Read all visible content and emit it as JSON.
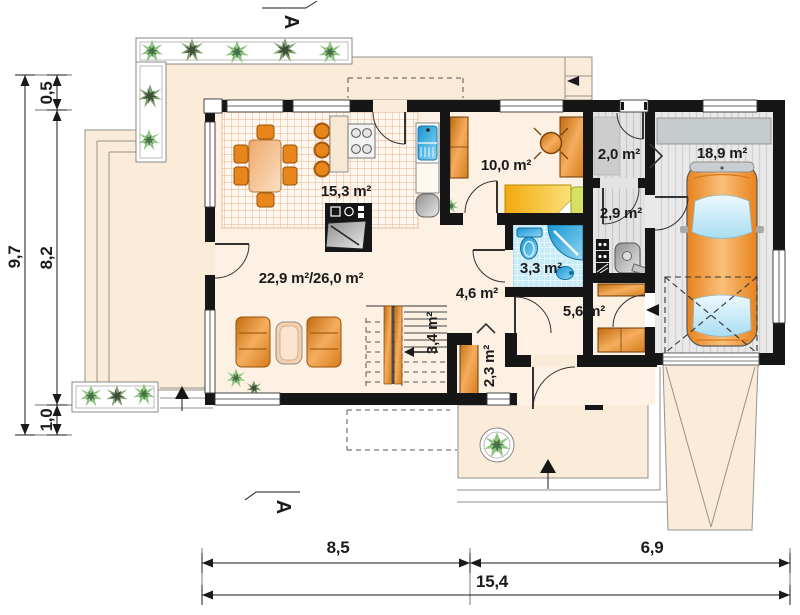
{
  "plan_type": "house ground floor plan",
  "section_markers": {
    "top": "A",
    "bottom": "A"
  },
  "rooms": {
    "kitchen_dining": "15,3 m²",
    "living_room": "22,9 m²/26,0 m²",
    "bedroom": "10,0 m²",
    "entry": "2,0 m²",
    "garage": "18,9 m²",
    "boiler_room": "2,9 m²",
    "bathroom": "3,3 m²",
    "hall": "4,6 m²",
    "corridor": "5,6 m²",
    "stairs": "3,4 m²",
    "vestibule": "2,3 m²"
  },
  "dimensions": {
    "left_total": "9,7",
    "left_top": "0,5",
    "left_middle": "8,2",
    "left_bottom": "1,0",
    "bottom_left": "8,5",
    "bottom_right": "6,9",
    "bottom_total": "15,4"
  },
  "colors": {
    "background": "#ffffff",
    "wall": "#161616",
    "interior_floor": "#fcf1e3",
    "terrace_floor": "#faecd9",
    "kitchen_tile_line": "#eeac86",
    "bathroom_tile": "#c8ebf8",
    "fixture_blue": "#2baae2",
    "furniture_wood": "#e8861c",
    "bed_yellow": "#f2a90e",
    "pillow_green": "#d6e063",
    "garage_floor": "#e9e9e9",
    "car_body": "#ef8c25",
    "plant_green": "#8cc57c"
  }
}
